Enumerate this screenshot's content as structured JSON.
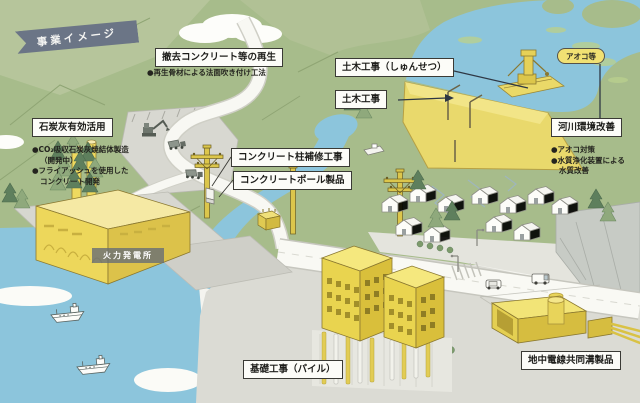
{
  "banner": {
    "title": "事業イメージ"
  },
  "labels": {
    "demolition": {
      "title": "撤去コンクリート等の再生",
      "bullet": "●再生骨材による法面吹き付け工法"
    },
    "coal_ash": {
      "title": "石炭灰有効活用",
      "bullets": [
        "●CO₂吸収石炭灰焼結体製造",
        "（開発中）",
        "●フライアッシュを使用した",
        "コンクリート開発"
      ]
    },
    "pole_repair": {
      "title": "コンクリート柱補修工事"
    },
    "pole_product": {
      "title": "コンクリートポール製品"
    },
    "civil_dredge": {
      "title": "土木工事（しゅんせつ）"
    },
    "civil": {
      "title": "土木工事"
    },
    "algae": {
      "title": "アオコ等"
    },
    "river_env": {
      "title": "河川環境改善",
      "bullets": [
        "●アオコ対策",
        "●水質浄化装置による",
        "水質改善"
      ]
    },
    "foundation": {
      "title": "基礎工事（パイル）"
    },
    "underground": {
      "title": "地中電線共同溝製品"
    },
    "power_plant": {
      "title": "火力発電所"
    }
  },
  "scene": {
    "items": [
      "hills",
      "upper-river",
      "dam",
      "dredger",
      "algae-water",
      "center-river",
      "pond",
      "sea",
      "cargo-ships",
      "thermal-power-plant",
      "pier",
      "mountain-road",
      "work-pad",
      "excavator",
      "dump-trucks",
      "bridge",
      "utility-poles",
      "transformer",
      "houses",
      "trees",
      "highway",
      "crosswalk",
      "cars",
      "street-lights",
      "apartment-buildings",
      "foundation-piles",
      "utility-tunnel",
      "manhole",
      "cables",
      "cliff",
      "clouds"
    ]
  },
  "colors": {
    "banner_bg": "#6b7586",
    "label_bg": "#fcfcf8",
    "label_border": "#3a3a35",
    "algae_capsule_bg": "#f1e173",
    "hill_green": "#a7bc8b",
    "water_blue": "#8cc5dc",
    "accent_yellow": "#ecd75c",
    "ground_gray": "#dbdbd4"
  }
}
